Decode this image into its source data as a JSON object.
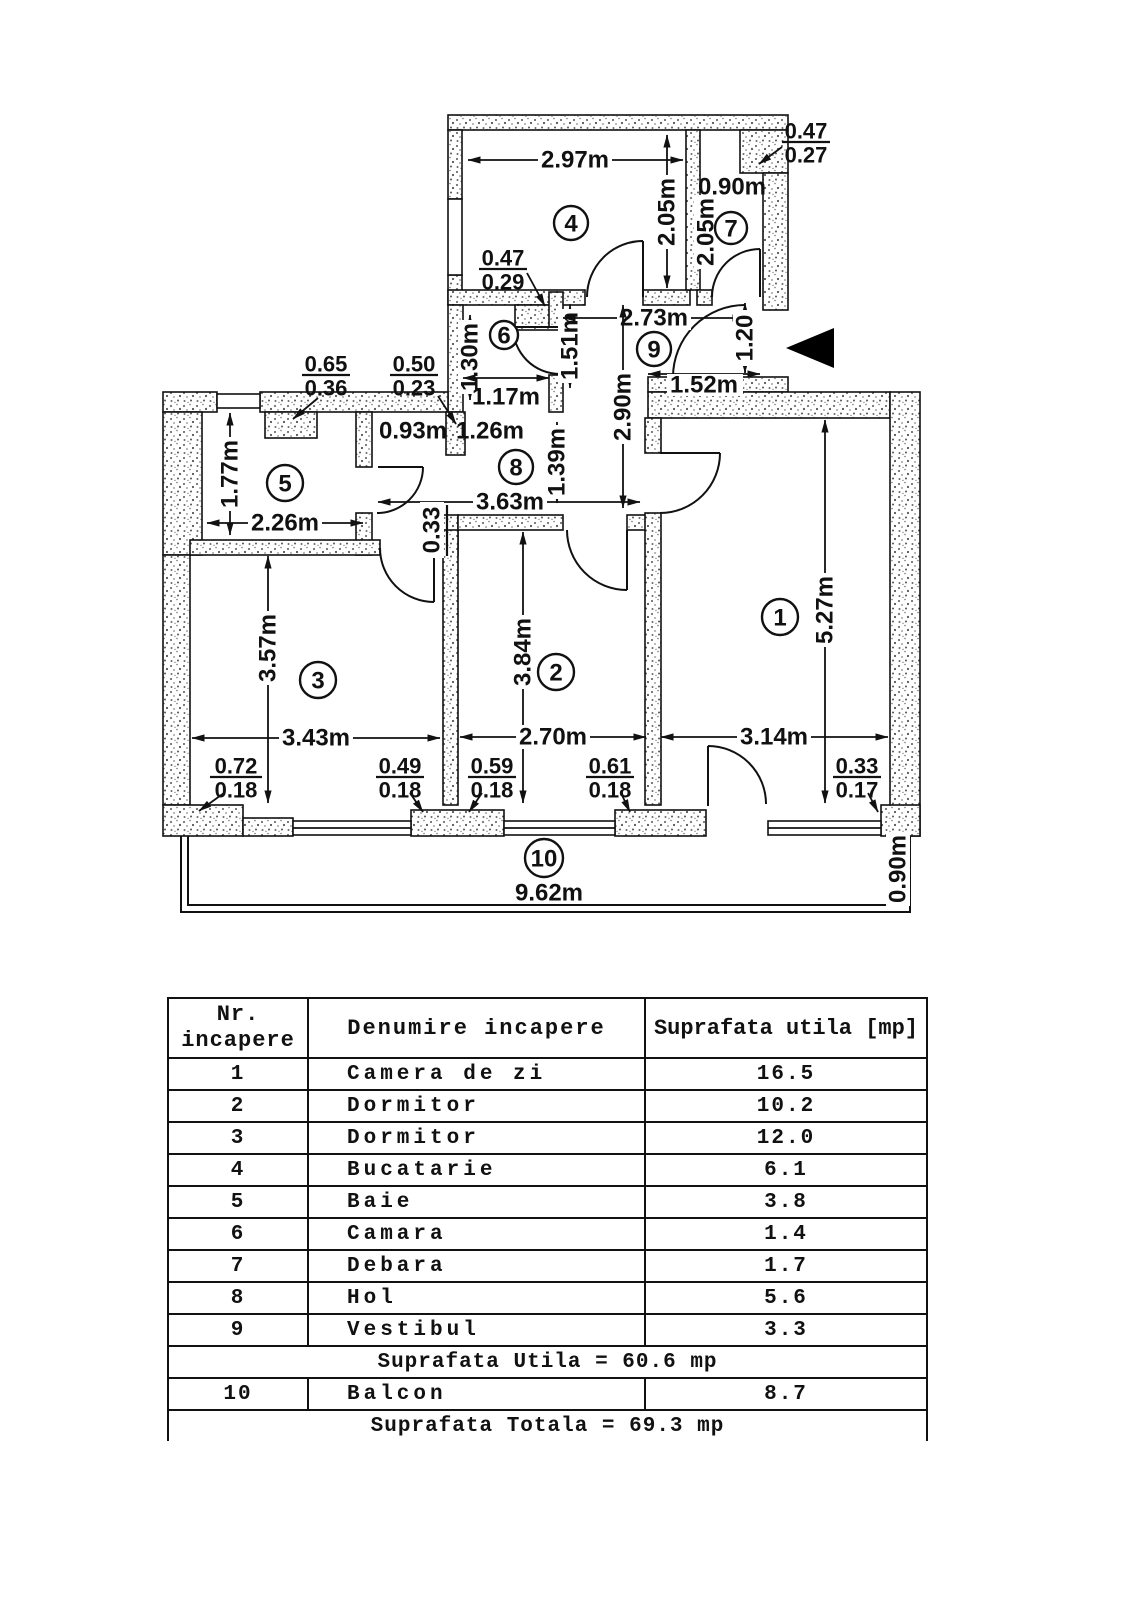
{
  "plan": {
    "rooms": {
      "r1": "1",
      "r2": "2",
      "r3": "3",
      "r4": "4",
      "r5": "5",
      "r6": "6",
      "r7": "7",
      "r8": "8",
      "r9": "9",
      "r10": "10"
    },
    "dims": {
      "room4_width": "2.97m",
      "room4_height": "2.05m",
      "room7_width": "0.90m",
      "room7_height": "2.05m",
      "camara_height": "1.30m",
      "camara_opening": "1.17m",
      "hol_upper": "1.51m",
      "vestibul_width": "2.73m",
      "vestibul_height": "2.90m",
      "entry_door": "1.20",
      "entry_wall": "1.52m",
      "baie_height": "1.77m",
      "baie_width": "2.26m",
      "opening_left": "0.93m",
      "opening_right": "1.26m",
      "hol_width": "3.63m",
      "hol_height": "1.39m",
      "wall_step": "0.33",
      "room3_height": "3.57m",
      "room3_width": "3.43m",
      "room2_height": "3.84m",
      "room2_width": "2.70m",
      "room1_height": "5.27m",
      "room1_width": "3.14m",
      "balcon_width": "9.62m",
      "balcon_depth": "0.90m"
    },
    "fractions": {
      "f_top_right": {
        "top": "0.47",
        "bottom": "0.27"
      },
      "f_room4": {
        "top": "0.47",
        "bottom": "0.29"
      },
      "f_left_a": {
        "top": "0.65",
        "bottom": "0.36"
      },
      "f_left_b": {
        "top": "0.50",
        "bottom": "0.23"
      },
      "f_win3a": {
        "top": "0.72",
        "bottom": "0.18"
      },
      "f_win3b": {
        "top": "0.49",
        "bottom": "0.18"
      },
      "f_win2a": {
        "top": "0.59",
        "bottom": "0.18"
      },
      "f_win2b": {
        "top": "0.61",
        "bottom": "0.18"
      },
      "f_win1": {
        "top": "0.33",
        "bottom": "0.17"
      }
    }
  },
  "table": {
    "headers": {
      "col1_line1": "Nr.",
      "col1_line2": "incapere",
      "col2": "Denumire incapere",
      "col3": "Suprafata utila [mp]"
    },
    "rows": [
      {
        "nr": "1",
        "name": "Camera de zi",
        "area": "16.5"
      },
      {
        "nr": "2",
        "name": "Dormitor",
        "area": "10.2"
      },
      {
        "nr": "3",
        "name": "Dormitor",
        "area": "12.0"
      },
      {
        "nr": "4",
        "name": "Bucatarie",
        "area": "6.1"
      },
      {
        "nr": "5",
        "name": "Baie",
        "area": "3.8"
      },
      {
        "nr": "6",
        "name": "Camara",
        "area": "1.4"
      },
      {
        "nr": "7",
        "name": "Debara",
        "area": "1.7"
      },
      {
        "nr": "8",
        "name": "Hol",
        "area": "5.6"
      },
      {
        "nr": "9",
        "name": "Vestibul",
        "area": "3.3"
      }
    ],
    "subtotal": "Suprafata Utila = 60.6 mp",
    "row10": {
      "nr": "10",
      "name": "Balcon",
      "area": "8.7"
    },
    "total": "Suprafata Totala = 69.3 mp"
  }
}
